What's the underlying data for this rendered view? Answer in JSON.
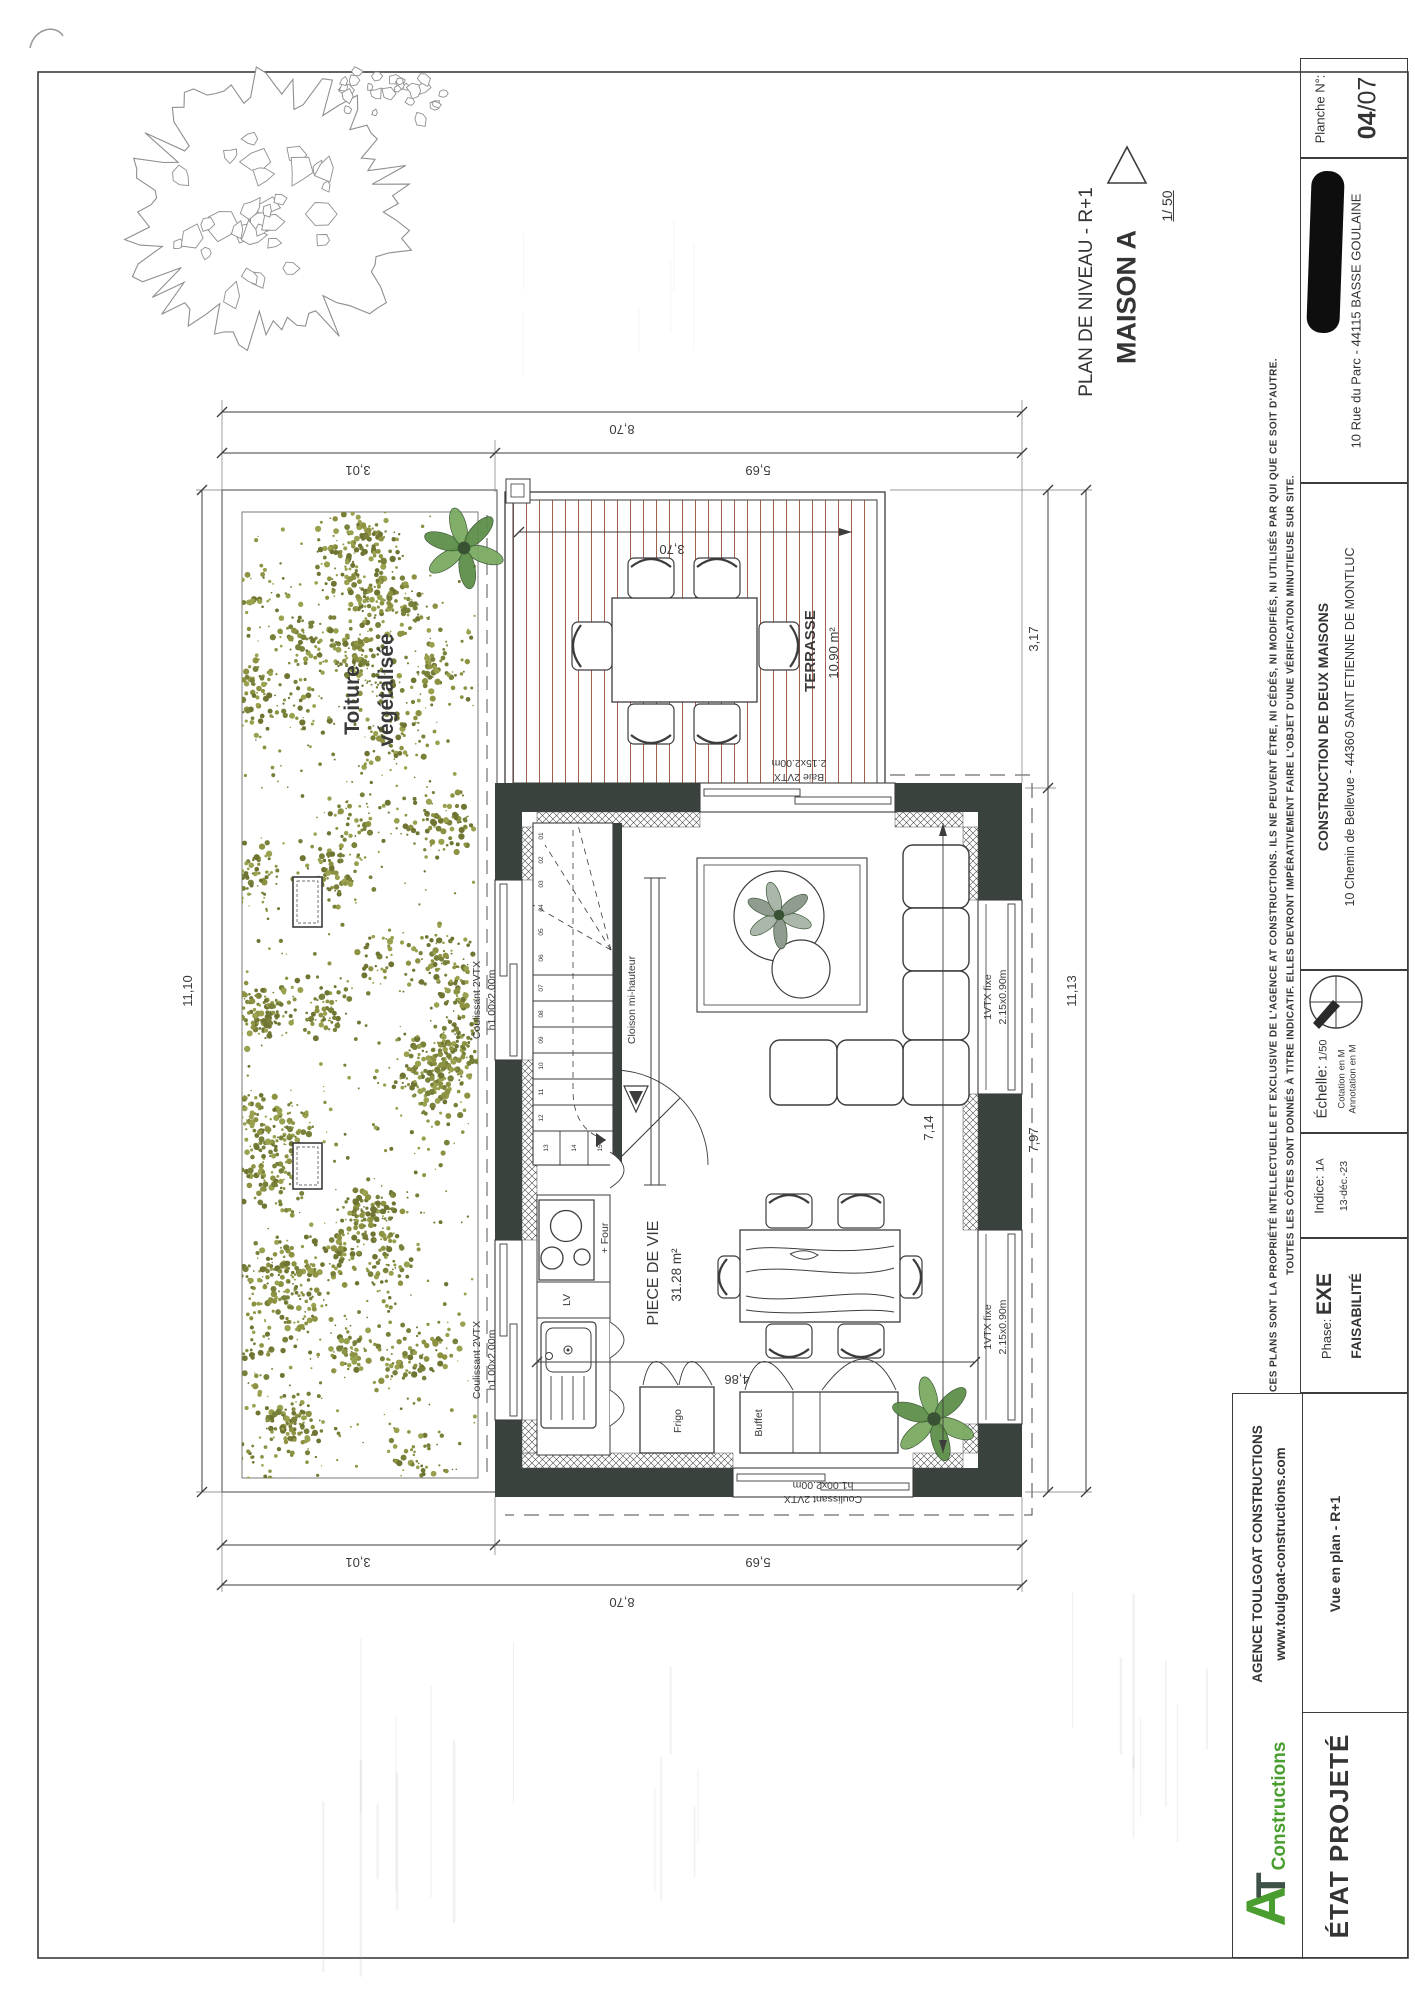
{
  "sheet": {
    "planche": {
      "label": "Planche N°:",
      "num": "04",
      "den": "/07"
    },
    "client": {
      "address": "10 Rue du Parc - 44115 BASSE GOULAINE"
    },
    "project": {
      "title": "CONSTRUCTION DE DEUX MAISONS",
      "address": "10 Chemin de Bellevue - 44360 SAINT ETIENNE DE MONTLUC"
    },
    "drawing": {
      "level": "PLAN DE NIVEAU - R+1",
      "name": "MAISON A",
      "scale": "1/ 50"
    },
    "echelle": {
      "label": "Échelle:",
      "value": "1/50",
      "cotation": "Cotation en M",
      "annotation": "Annotation en M"
    },
    "indice": {
      "label": "Indice:",
      "value": "1A",
      "date": "13-déc.-23"
    },
    "phase": {
      "label": "Phase:",
      "value": "EXE",
      "status": "FAISABILITÉ"
    },
    "agency": {
      "name": "AGENCE TOULGOAT CONSTRUCTIONS",
      "site": "www.toulgoat-constructions.com",
      "logo_a": "A",
      "logo_t": "T",
      "logo_text": "Constructions"
    },
    "footer": {
      "view": "Vue en plan - R+1",
      "state": "ÉTAT PROJETÉ"
    },
    "disclaimer": {
      "line1": "CES PLANS SONT LA PROPRIÉTÉ INTELLECTUELLE ET EXCLUSIVE DE L'AGENCE AT CONSTRUCTIONS.  ILS NE PEUVENT ÊTRE, NI CÉDÉS, NI MODIFIÉS, NI UTILISÉS PAR QUI QUE CE SOIT D'AUTRE.",
      "line2": "TOUTES LES CÔTES SONT DONNÉS À TITRE INDICATIF. ELLES DEVRONT IMPÉRATIVEMENT FAIRE L'OBJET D'UNE VÉRIFICATION MINUTIEUSE SUR SITE."
    }
  },
  "plan": {
    "rooms": {
      "roof1": "Toiture",
      "roof2": "végétalisée",
      "terrace": "TERRASSE",
      "terrace_area": "10.90 m²",
      "living": "PIECE DE VIE",
      "living_area": "31.28 m²"
    },
    "windows": {
      "baie1": "Baie 2VTX",
      "baie2": "2.15x2.00m",
      "coul1": "Coulissant 2VTX",
      "coul2": "h1.00x2.00m",
      "fixe1": "1VTX fixe",
      "fixe2": "2.15x0.90m"
    },
    "items": {
      "frigo": "Frigo",
      "buffet": "Buffet",
      "lv": "LV",
      "four": "+ Four",
      "cloison": "Cloison mi-hauteur"
    },
    "dims": {
      "total": "8,70",
      "seg1": "3,01",
      "seg2": "5,69",
      "left": "11,10",
      "right_total": "11,13",
      "right_top": "3,17",
      "right_bottom": "7,97",
      "inner_h": "7,14",
      "inner_w": "4,86",
      "terrace_w": "3,70"
    },
    "stairs": {
      "steps": [
        "01",
        "02",
        "03",
        "04",
        "05",
        "06",
        "07",
        "08",
        "09",
        "10",
        "11",
        "12",
        "13",
        "14",
        "15"
      ]
    },
    "colors": {
      "wall": "#39423d",
      "deck_line": "#a2604c",
      "vegetation": "#8d9242",
      "logo_green": "#4a9e2f"
    }
  }
}
